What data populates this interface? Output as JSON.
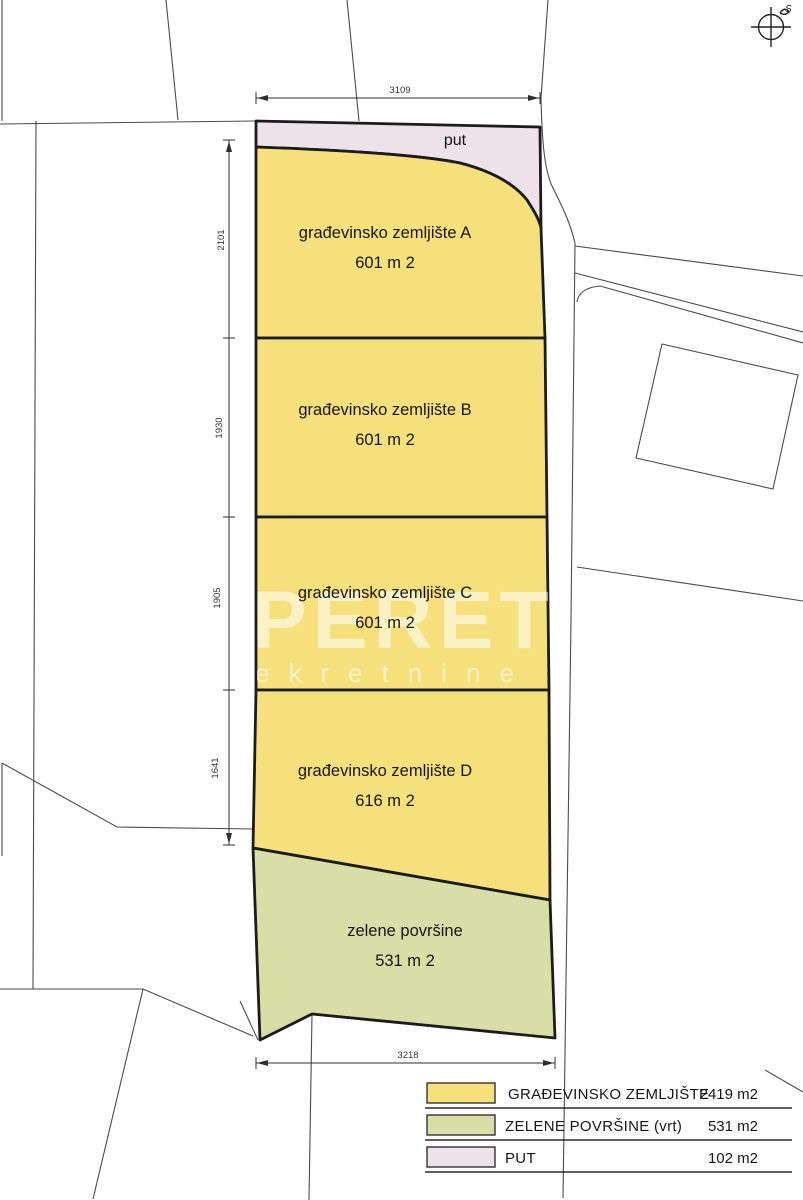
{
  "title": "parcelization site plan",
  "compass": {
    "north_label": "S"
  },
  "dimensions": {
    "top": "3109",
    "bottom": "3218",
    "left_segments": [
      "2101",
      "1930",
      "1905",
      "1641"
    ]
  },
  "parcels": {
    "put": {
      "label": "put"
    },
    "a": {
      "name": "građevinsko zemljište A",
      "area": "601 m 2"
    },
    "b": {
      "name": "građevinsko zemljište B",
      "area": "601 m 2"
    },
    "c": {
      "name": "građevinsko zemljište C",
      "area": "601 m 2"
    },
    "d": {
      "name": "građevinsko zemljište D",
      "area": "616 m 2"
    },
    "green": {
      "name": "zelene površine",
      "area": "531 m 2"
    }
  },
  "colors": {
    "building_land": "#f6e07c",
    "green_area": "#d8dfa6",
    "road": "#ede2e7"
  },
  "legend": {
    "rows": [
      {
        "label": "GRAĐEVINSKO ZEMLJIŠTE",
        "value": "2419 m2",
        "color": "#f6e07c"
      },
      {
        "label": "ZELENE POVRŠINE (vrt)",
        "value": "531 m2",
        "color": "#d8dfa6"
      },
      {
        "label": "PUT",
        "value": "102 m2",
        "color": "#ede2e7"
      }
    ]
  },
  "watermark": {
    "line1": "PERETI",
    "line2": "ekretnine"
  }
}
